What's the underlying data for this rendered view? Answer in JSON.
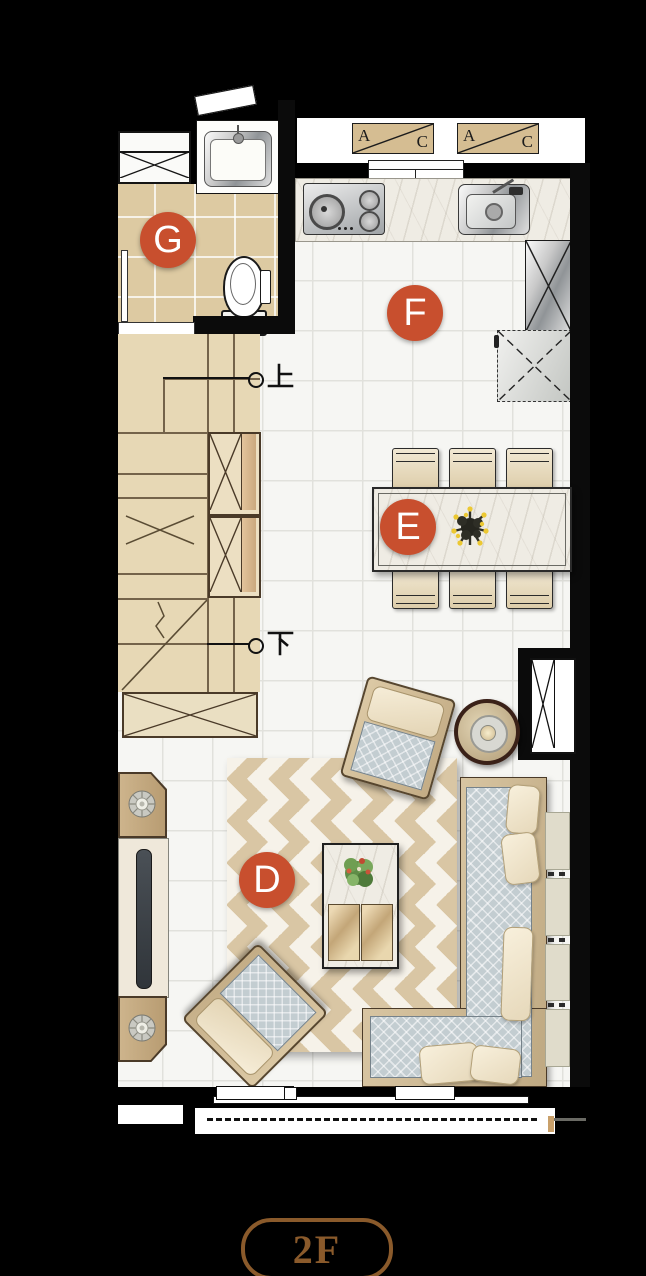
{
  "plan": {
    "floor_badge": "2F",
    "rooms": {
      "living": {
        "label": "D"
      },
      "dining": {
        "label": "E"
      },
      "kitchen": {
        "label": "F"
      },
      "bathroom": {
        "label": "G"
      }
    },
    "stairs": {
      "up": "上",
      "down": "下"
    },
    "ac_units": [
      {
        "first": "A",
        "second": "C"
      },
      {
        "first": "A",
        "second": "C"
      }
    ],
    "colors": {
      "room_label_bg": "#c84f2e",
      "room_label_text": "#ffffff",
      "floor_badge": "#8a5a2b",
      "background": "#000000"
    }
  }
}
